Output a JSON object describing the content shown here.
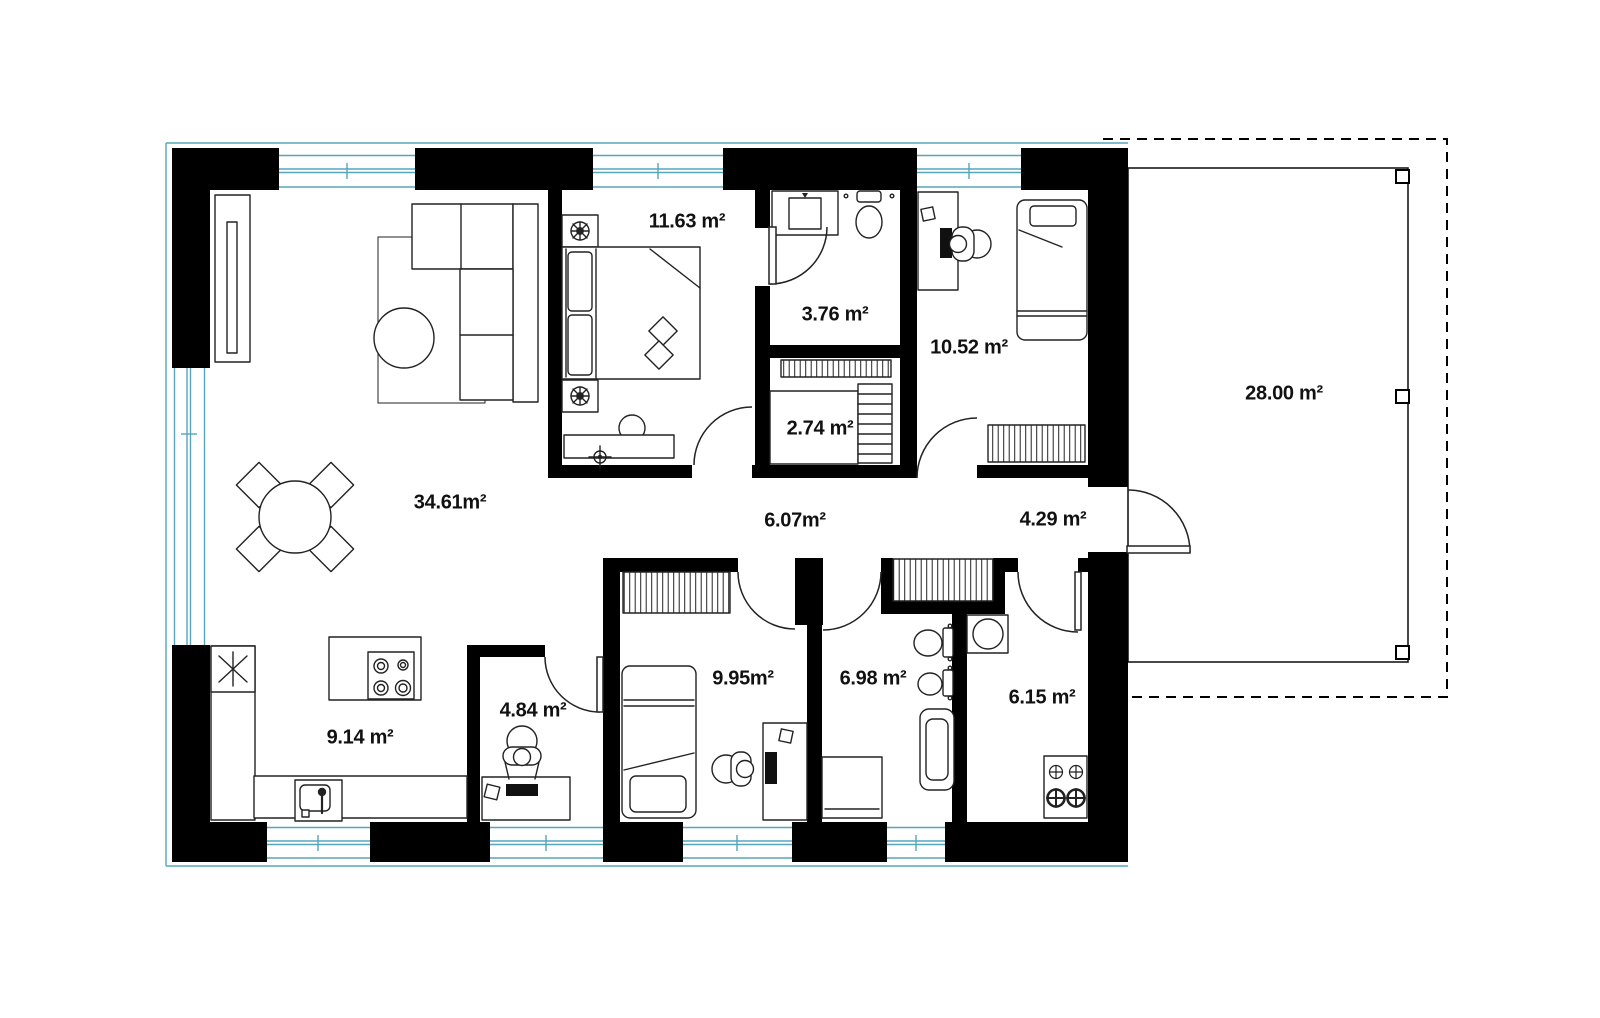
{
  "document": {
    "type": "floor-plan"
  },
  "colors": {
    "wall": "#000000",
    "glazing": "#55a5bc",
    "line": "#222222",
    "background": "#ffffff",
    "label": "#111111"
  },
  "rooms": [
    {
      "id": "living-room",
      "area": "34.61m²"
    },
    {
      "id": "bedroom-main",
      "area": "11.63 m²"
    },
    {
      "id": "bathroom-small",
      "area": "3.76 m²"
    },
    {
      "id": "wardrobe",
      "area": "2.74 m²"
    },
    {
      "id": "bedroom-right",
      "area": "10.52 m²"
    },
    {
      "id": "hallway-main",
      "area": "6.07m²"
    },
    {
      "id": "hallway-entry",
      "area": "4.29 m²"
    },
    {
      "id": "terrace",
      "area": "28.00 m²"
    },
    {
      "id": "kitchen",
      "area": "9.14 m²"
    },
    {
      "id": "office",
      "area": "4.84 m²"
    },
    {
      "id": "bedroom-bottom",
      "area": "9.95m²"
    },
    {
      "id": "bathroom-large",
      "area": "6.98 m²"
    },
    {
      "id": "utility-room",
      "area": "6.15 m²"
    }
  ]
}
